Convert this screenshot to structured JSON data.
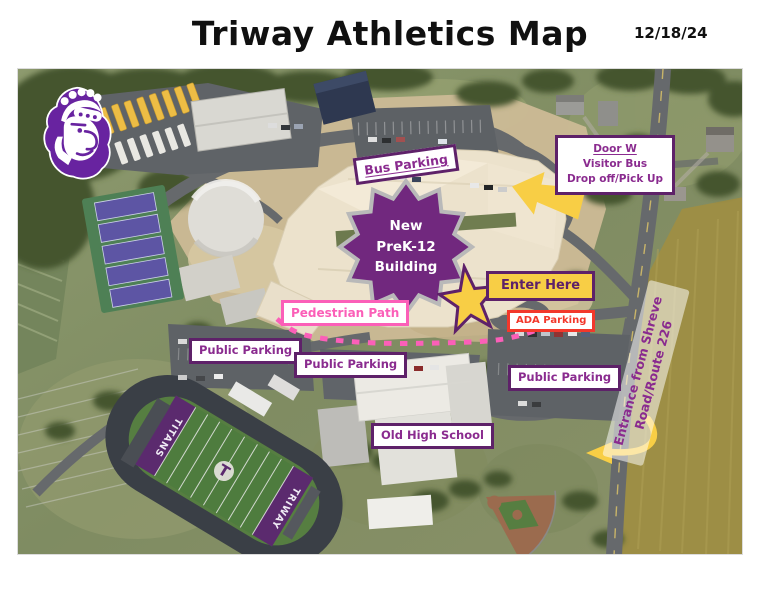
{
  "colors": {
    "purple_dark": "#5E2169",
    "purple": "#8A2B8F",
    "starburst_purple": "#71287E",
    "star_border_gray": "#B9B9B9",
    "yellow": "#F8CE45",
    "pink": "#FB5FB8",
    "red": "#F2382B",
    "logo_purple": "#6823A0"
  },
  "header": {
    "title": "Triway Athletics Map",
    "date": "12/18/24"
  },
  "labels": {
    "bus_parking": "Bus Parking",
    "door_w": {
      "line1": "Door W",
      "line2": "Visitor Bus",
      "line3": "Drop off/Pick Up"
    },
    "new_building": {
      "line1": "New",
      "line2": "PreK-12",
      "line3": "Building"
    },
    "enter_here": "Enter Here",
    "pedestrian_path": "Pedestrian Path",
    "ada_parking": "ADA Parking",
    "public_parking": "Public Parking",
    "old_high_school": "Old High School",
    "entrance": {
      "line1": "Entrance from Shreve",
      "line2": "Road/Route 226"
    }
  },
  "map_features": {
    "football_field": {
      "end_zone_left": "TITANS",
      "end_zone_right": "TRIWAY",
      "midfield_letter": "T"
    }
  }
}
